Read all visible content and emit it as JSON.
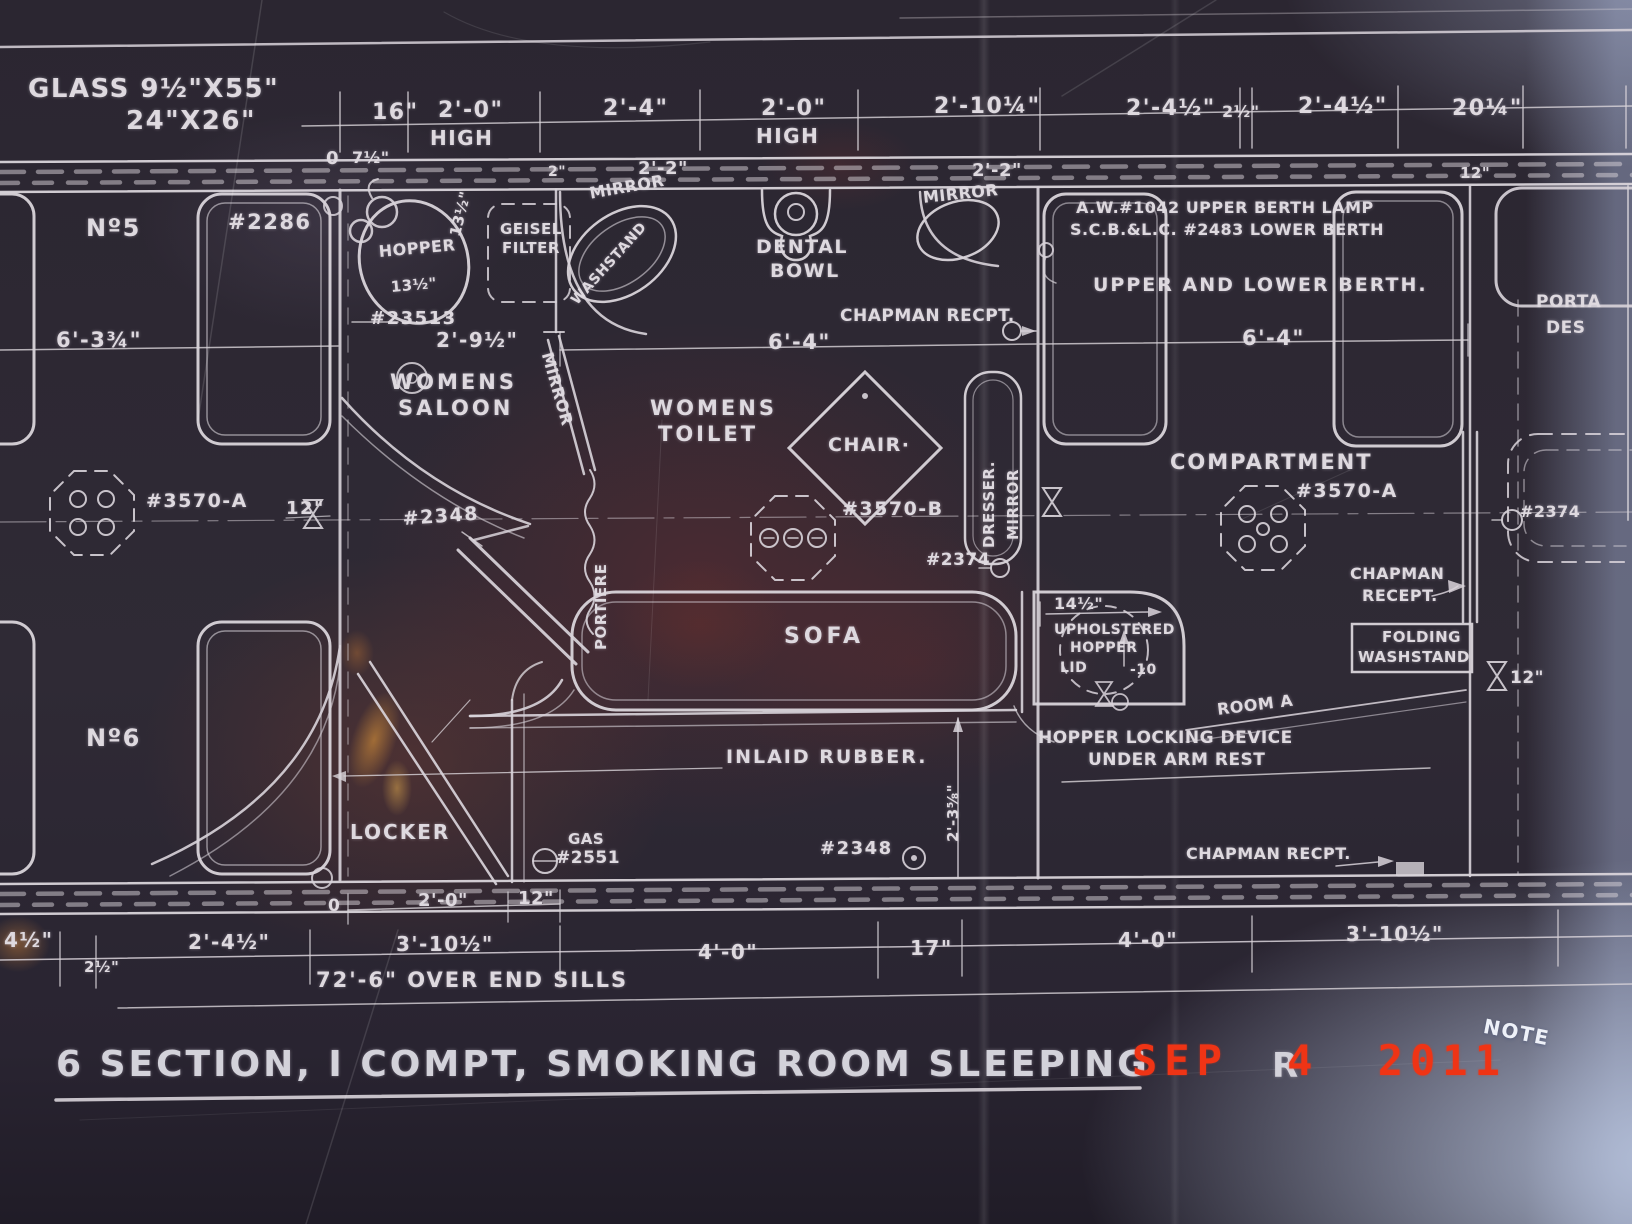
{
  "photo": {
    "kind": "blueprint-photograph",
    "line_color": "#d9d4da",
    "background_color": "#2b2631",
    "stamp_color": "#ef3415"
  },
  "labels": {
    "glass1": "GLASS 9½\"X55\"",
    "glass2": "24\"X26\"",
    "dim16": "16\"",
    "dim20a": "2'-0\"",
    "high_a": "HIGH",
    "dim24a": "2'-4\"",
    "dim20b": "2'-0\"",
    "high_b": "HIGH",
    "dim2104": "2'-10¼\"",
    "dim2412a": "2'-4½\"",
    "dim212top": "2½\"",
    "dim2412b": "2'-4½\"",
    "dim2014": "20¼\"",
    "zero_a": "0",
    "dim712": "7½\"",
    "dim2small": "2\"",
    "dim22a": "2'-2\"",
    "dim22b": "2'-2\"",
    "dim12top": "12\"",
    "no5": "Nº5",
    "part2286": "#2286",
    "hopper": "HOPPER",
    "dim1312v": "13½\"",
    "dim1312h": "13½\"",
    "geisel1": "GEISEL",
    "geisel2": "FILTER",
    "part23513": "#23513",
    "dim2912": "2'-9½\"",
    "mirror_ws": "MIRROR",
    "washstand": "WASHSTAND",
    "dental1": "DENTAL",
    "dental2": "BOWL",
    "mirror_tr": "MIRROR",
    "chapman_top": "CHAPMAN RECPT.",
    "aw1": "A.W.#1042 UPPER BERTH LAMP",
    "aw2": "S.C.B.&L.C. #2483 LOWER BERTH",
    "upper_lower": "UPPER AND LOWER BERTH.",
    "dim64_l": "6'-4\"",
    "dim64_r": "6'-4\"",
    "dim634": "6'-3¾\"",
    "womens_saloon_1": "WOMENS",
    "womens_saloon_2": "SALOON",
    "mirror_diag": "MIRROR",
    "womens_toilet_1": "WOMENS",
    "womens_toilet_2": "TOILET",
    "chair": "CHAIR·",
    "dresser": "DRESSER.",
    "dresser_mirror": "MIRROR",
    "compartment": "COMPARTMENT",
    "part3570a_left": "#3570-A",
    "part3570a_right": "#3570-A",
    "part3570b": "#3570-B",
    "part2348_mid": "#2348",
    "part2374_mid": "#2374",
    "part2374_right": "#2374",
    "dim12_left": "12\"",
    "dim12_right": "12\"",
    "portiere": "PORTIERE",
    "chapman_r1": "CHAPMAN",
    "chapman_r2": "RECEPT.",
    "folding1": "FOLDING",
    "folding2": "WASHSTAND",
    "dim1412": "14½\"",
    "uph1": "UPHOLSTERED",
    "uph2": "HOPPER",
    "uph3": "LID",
    "minus10": "-10",
    "room_a": "ROOM A",
    "hopper_lock_1": "HOPPER LOCKING DEVICE",
    "hopper_lock_2": "UNDER ARM REST",
    "sofa": "SOFA",
    "inlaid": "INLAID RUBBER.",
    "dim2358": "2'-3⅝\"",
    "part2348_bottom": "#2348",
    "gas1": "GAS",
    "gas2": "#2551",
    "locker": "LOCKER",
    "no6": "Nº6",
    "chapman_bottom": "CHAPMAN RECPT.",
    "porta1": "PORTA",
    "porta2": "DES",
    "zero_b": "0",
    "dim20_bot": "2'-0\"",
    "dim12_bot": "12\"",
    "dim412_bl": "4½\"",
    "dim212_bl": "2½\"",
    "dim2412_bot": "2'-4½\"",
    "dim31012_a": "3'-10½\"",
    "dim40_a": "4'-0\"",
    "dim17": "17\"",
    "dim40_b": "4'-0\"",
    "dim31012_b": "3'-10½\"",
    "oversills": "72'-6\" OVER END SILLS",
    "title": "6 SECTION, I COMPT, SMOKING ROOM SLEEPING",
    "title_tail": "R",
    "note": "NOTE"
  },
  "stamp": {
    "date": "SEP 4 2011"
  }
}
